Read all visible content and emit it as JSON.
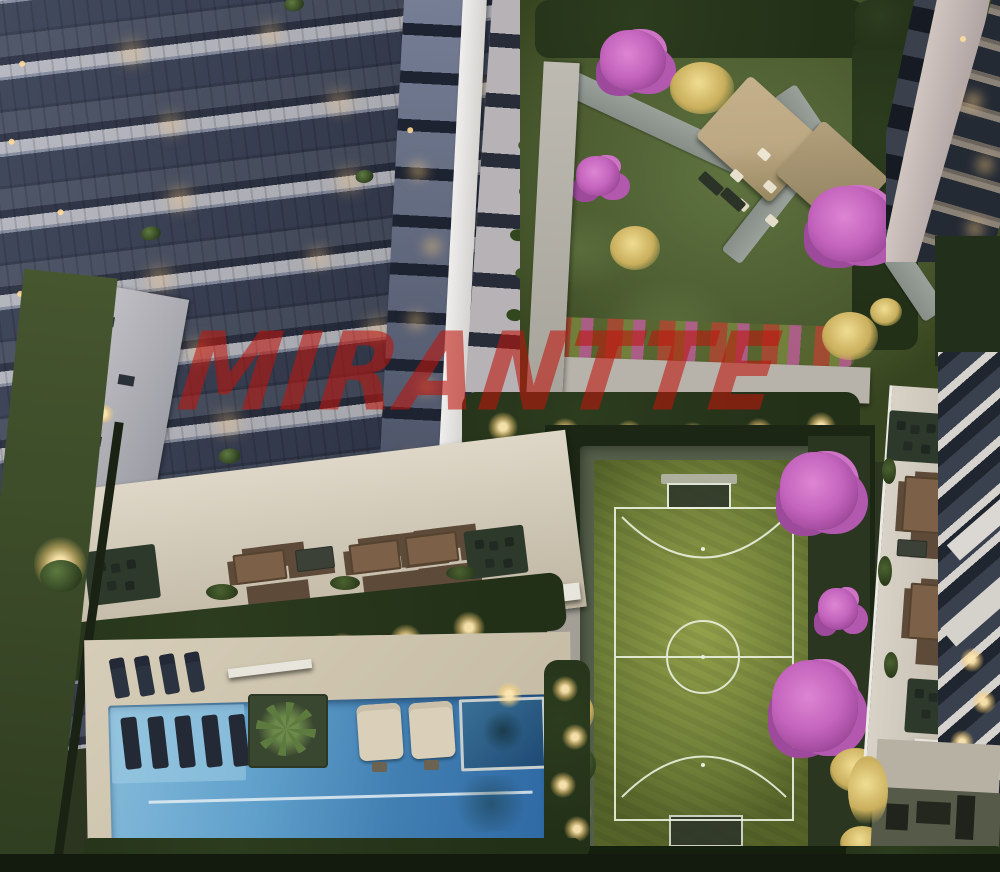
{
  "scene": {
    "watermark_text": "MIRANTTE"
  },
  "palette": {
    "watermark_red": "#c1140c",
    "slab_white": "#d7d5d7",
    "glass_dark": "#303748",
    "railing_gray": "#454c5a",
    "window_warm": "#ecd191",
    "lawn_green": "#5f7340",
    "lawn_dark": "#36441f",
    "field_green": "#95a24c",
    "field_dark": "#556329",
    "line_white": "#e9efdc",
    "pool_light": "#84bada",
    "pool_deep": "#2f69a4",
    "spa_dark": "#1e4a74",
    "deck_beige": "#d6cdb8",
    "wood_tan": "#bda884",
    "flower_pink": "#c565be",
    "foliage_dark": "#223018",
    "path_gray": "#9aa19b",
    "wall_pale": "#b7b3aa",
    "hedge_glow": "#ffd98c"
  }
}
